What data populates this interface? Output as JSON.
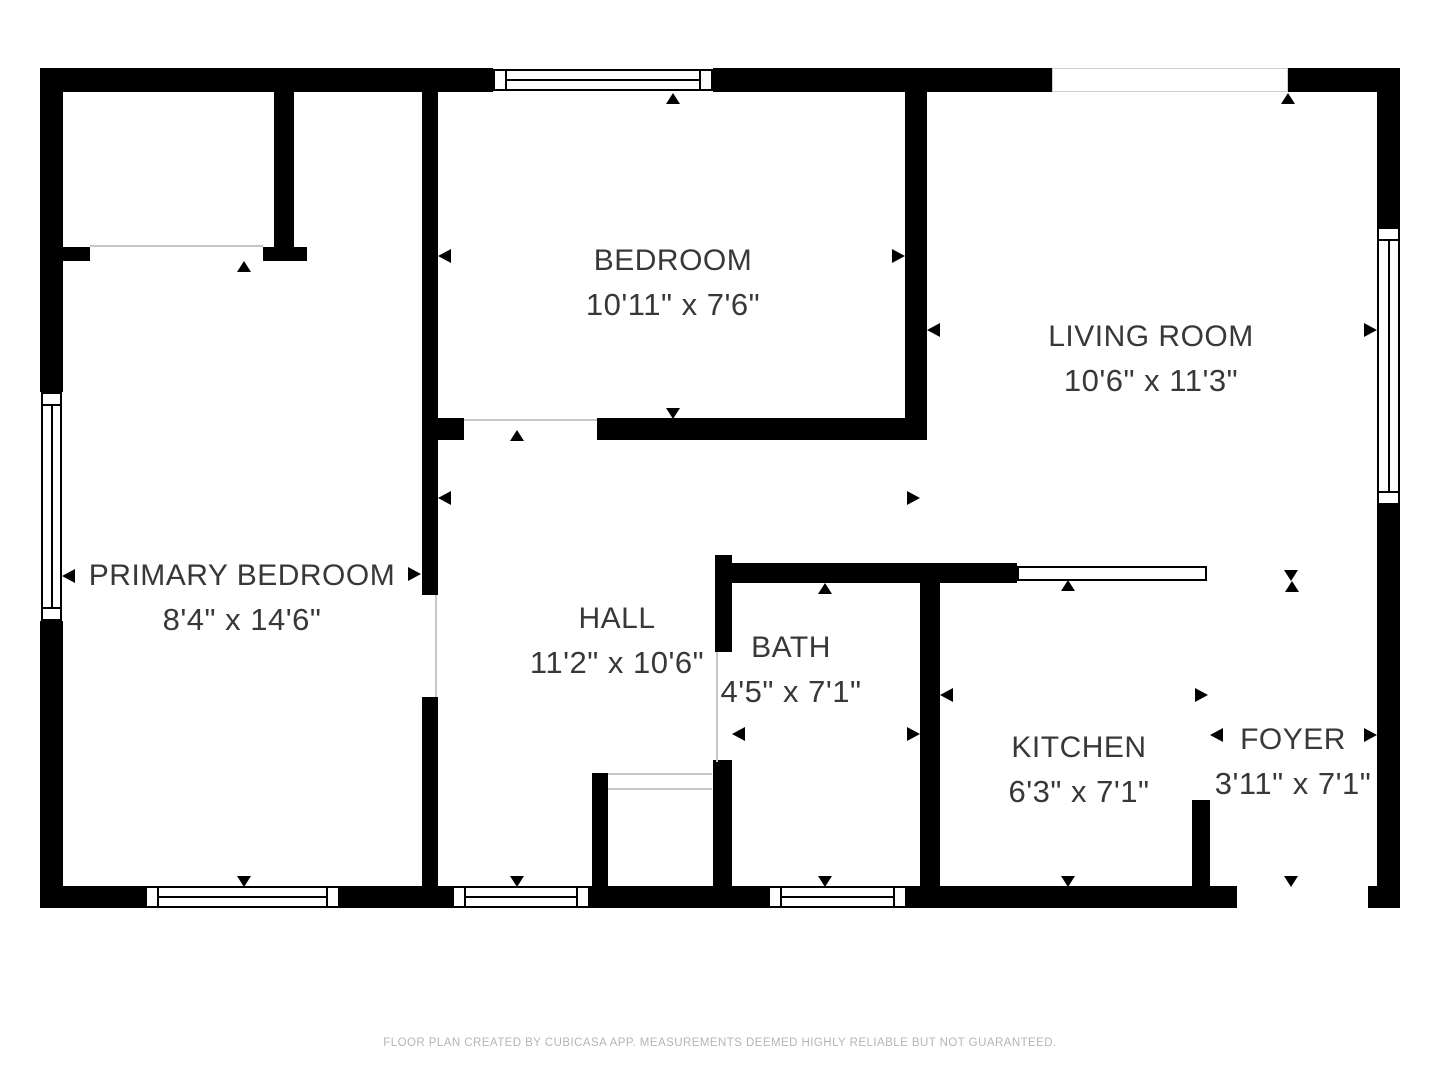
{
  "colors": {
    "wall": "#000000",
    "background": "#ffffff",
    "label_text": "#383838",
    "door_line": "#c6c6c6",
    "opening_outline": "#cfcfcf",
    "footer_text": "#b5b5b5"
  },
  "footer": {
    "text": "FLOOR PLAN CREATED BY CUBICASA APP. MEASUREMENTS DEEMED HIGHLY RELIABLE BUT NOT GUARANTEED."
  },
  "rooms": [
    {
      "name": "PRIMARY BEDROOM",
      "dimensions": "8'4\" x 14'6\"",
      "cx": 242,
      "cy": 576
    },
    {
      "name": "BEDROOM",
      "dimensions": "10'11\" x 7'6\"",
      "cx": 673,
      "cy": 261
    },
    {
      "name": "LIVING ROOM",
      "dimensions": "10'6\" x 11'3\"",
      "cx": 1151,
      "cy": 337
    },
    {
      "name": "HALL",
      "dimensions": "11'2\" x 10'6\"",
      "cx": 617,
      "cy": 619
    },
    {
      "name": "BATH",
      "dimensions": "4'5\" x 7'1\"",
      "cx": 791,
      "cy": 648
    },
    {
      "name": "KITCHEN",
      "dimensions": "6'3\" x 7'1\"",
      "cx": 1079,
      "cy": 748
    },
    {
      "name": "FOYER",
      "dimensions": "3'11\" x 7'1\"",
      "cx": 1293,
      "cy": 740
    }
  ],
  "walls": [
    [
      40,
      68,
      453,
      24
    ],
    [
      713,
      68,
      339,
      24
    ],
    [
      1288,
      68,
      112,
      24
    ],
    [
      40,
      886,
      105,
      22
    ],
    [
      340,
      886,
      112,
      22
    ],
    [
      590,
      886,
      178,
      22
    ],
    [
      907,
      886,
      330,
      22
    ],
    [
      1368,
      886,
      32,
      22
    ],
    [
      40,
      68,
      23,
      324
    ],
    [
      40,
      621,
      23,
      287
    ],
    [
      1377,
      68,
      23,
      159
    ],
    [
      1377,
      505,
      23,
      403
    ],
    [
      274,
      92,
      20,
      155
    ],
    [
      263,
      247,
      44,
      14
    ],
    [
      63,
      247,
      27,
      14
    ],
    [
      422,
      92,
      16,
      503
    ],
    [
      422,
      697,
      16,
      211
    ],
    [
      438,
      418,
      26,
      22
    ],
    [
      597,
      418,
      330,
      22
    ],
    [
      905,
      92,
      22,
      348
    ],
    [
      715,
      563,
      302,
      20
    ],
    [
      715,
      555,
      17,
      97
    ],
    [
      713,
      760,
      19,
      126
    ],
    [
      920,
      563,
      20,
      323
    ],
    [
      592,
      773,
      16,
      113
    ],
    [
      1192,
      800,
      18,
      86
    ]
  ],
  "windows": [
    [
      493,
      69,
      220,
      22,
      "h"
    ],
    [
      145,
      886,
      195,
      22,
      "h"
    ],
    [
      452,
      886,
      138,
      22,
      "h"
    ],
    [
      768,
      886,
      139,
      22,
      "h"
    ],
    [
      41,
      392,
      21,
      229,
      "v"
    ],
    [
      1377,
      227,
      23,
      278,
      "v"
    ]
  ],
  "openings": [
    [
      1052,
      68,
      236,
      24
    ]
  ],
  "gaps": [
    [
      1237,
      886,
      131,
      22
    ]
  ],
  "half_walls": [
    [
      1017,
      566,
      190,
      15
    ]
  ],
  "door_lines": [
    [
      90,
      245,
      173,
      2
    ],
    [
      464,
      419,
      133,
      2
    ],
    [
      435,
      595,
      2,
      102
    ],
    [
      716,
      652,
      2,
      110
    ],
    [
      608,
      773,
      104,
      2
    ],
    [
      608,
      788,
      104,
      2
    ]
  ],
  "arrows": [
    [
      "left",
      68,
      576
    ],
    [
      "right",
      414,
      574
    ],
    [
      "up",
      244,
      266
    ],
    [
      "down",
      244,
      881
    ],
    [
      "left",
      444,
      256
    ],
    [
      "right",
      898,
      256
    ],
    [
      "up",
      673,
      98
    ],
    [
      "down",
      673,
      413
    ],
    [
      "left",
      933,
      330
    ],
    [
      "right",
      1370,
      330
    ],
    [
      "up",
      1288,
      98
    ],
    [
      "down",
      1291,
      575
    ],
    [
      "left",
      444,
      498
    ],
    [
      "right",
      913,
      498
    ],
    [
      "up",
      517,
      435
    ],
    [
      "down",
      517,
      881
    ],
    [
      "left",
      738,
      734
    ],
    [
      "right",
      913,
      734
    ],
    [
      "up",
      825,
      588
    ],
    [
      "down",
      825,
      881
    ],
    [
      "left",
      946,
      695
    ],
    [
      "right",
      1201,
      695
    ],
    [
      "up",
      1068,
      585
    ],
    [
      "down",
      1068,
      881
    ],
    [
      "left",
      1216,
      735
    ],
    [
      "right",
      1370,
      735
    ],
    [
      "up",
      1292,
      586
    ],
    [
      "down",
      1291,
      881
    ]
  ]
}
